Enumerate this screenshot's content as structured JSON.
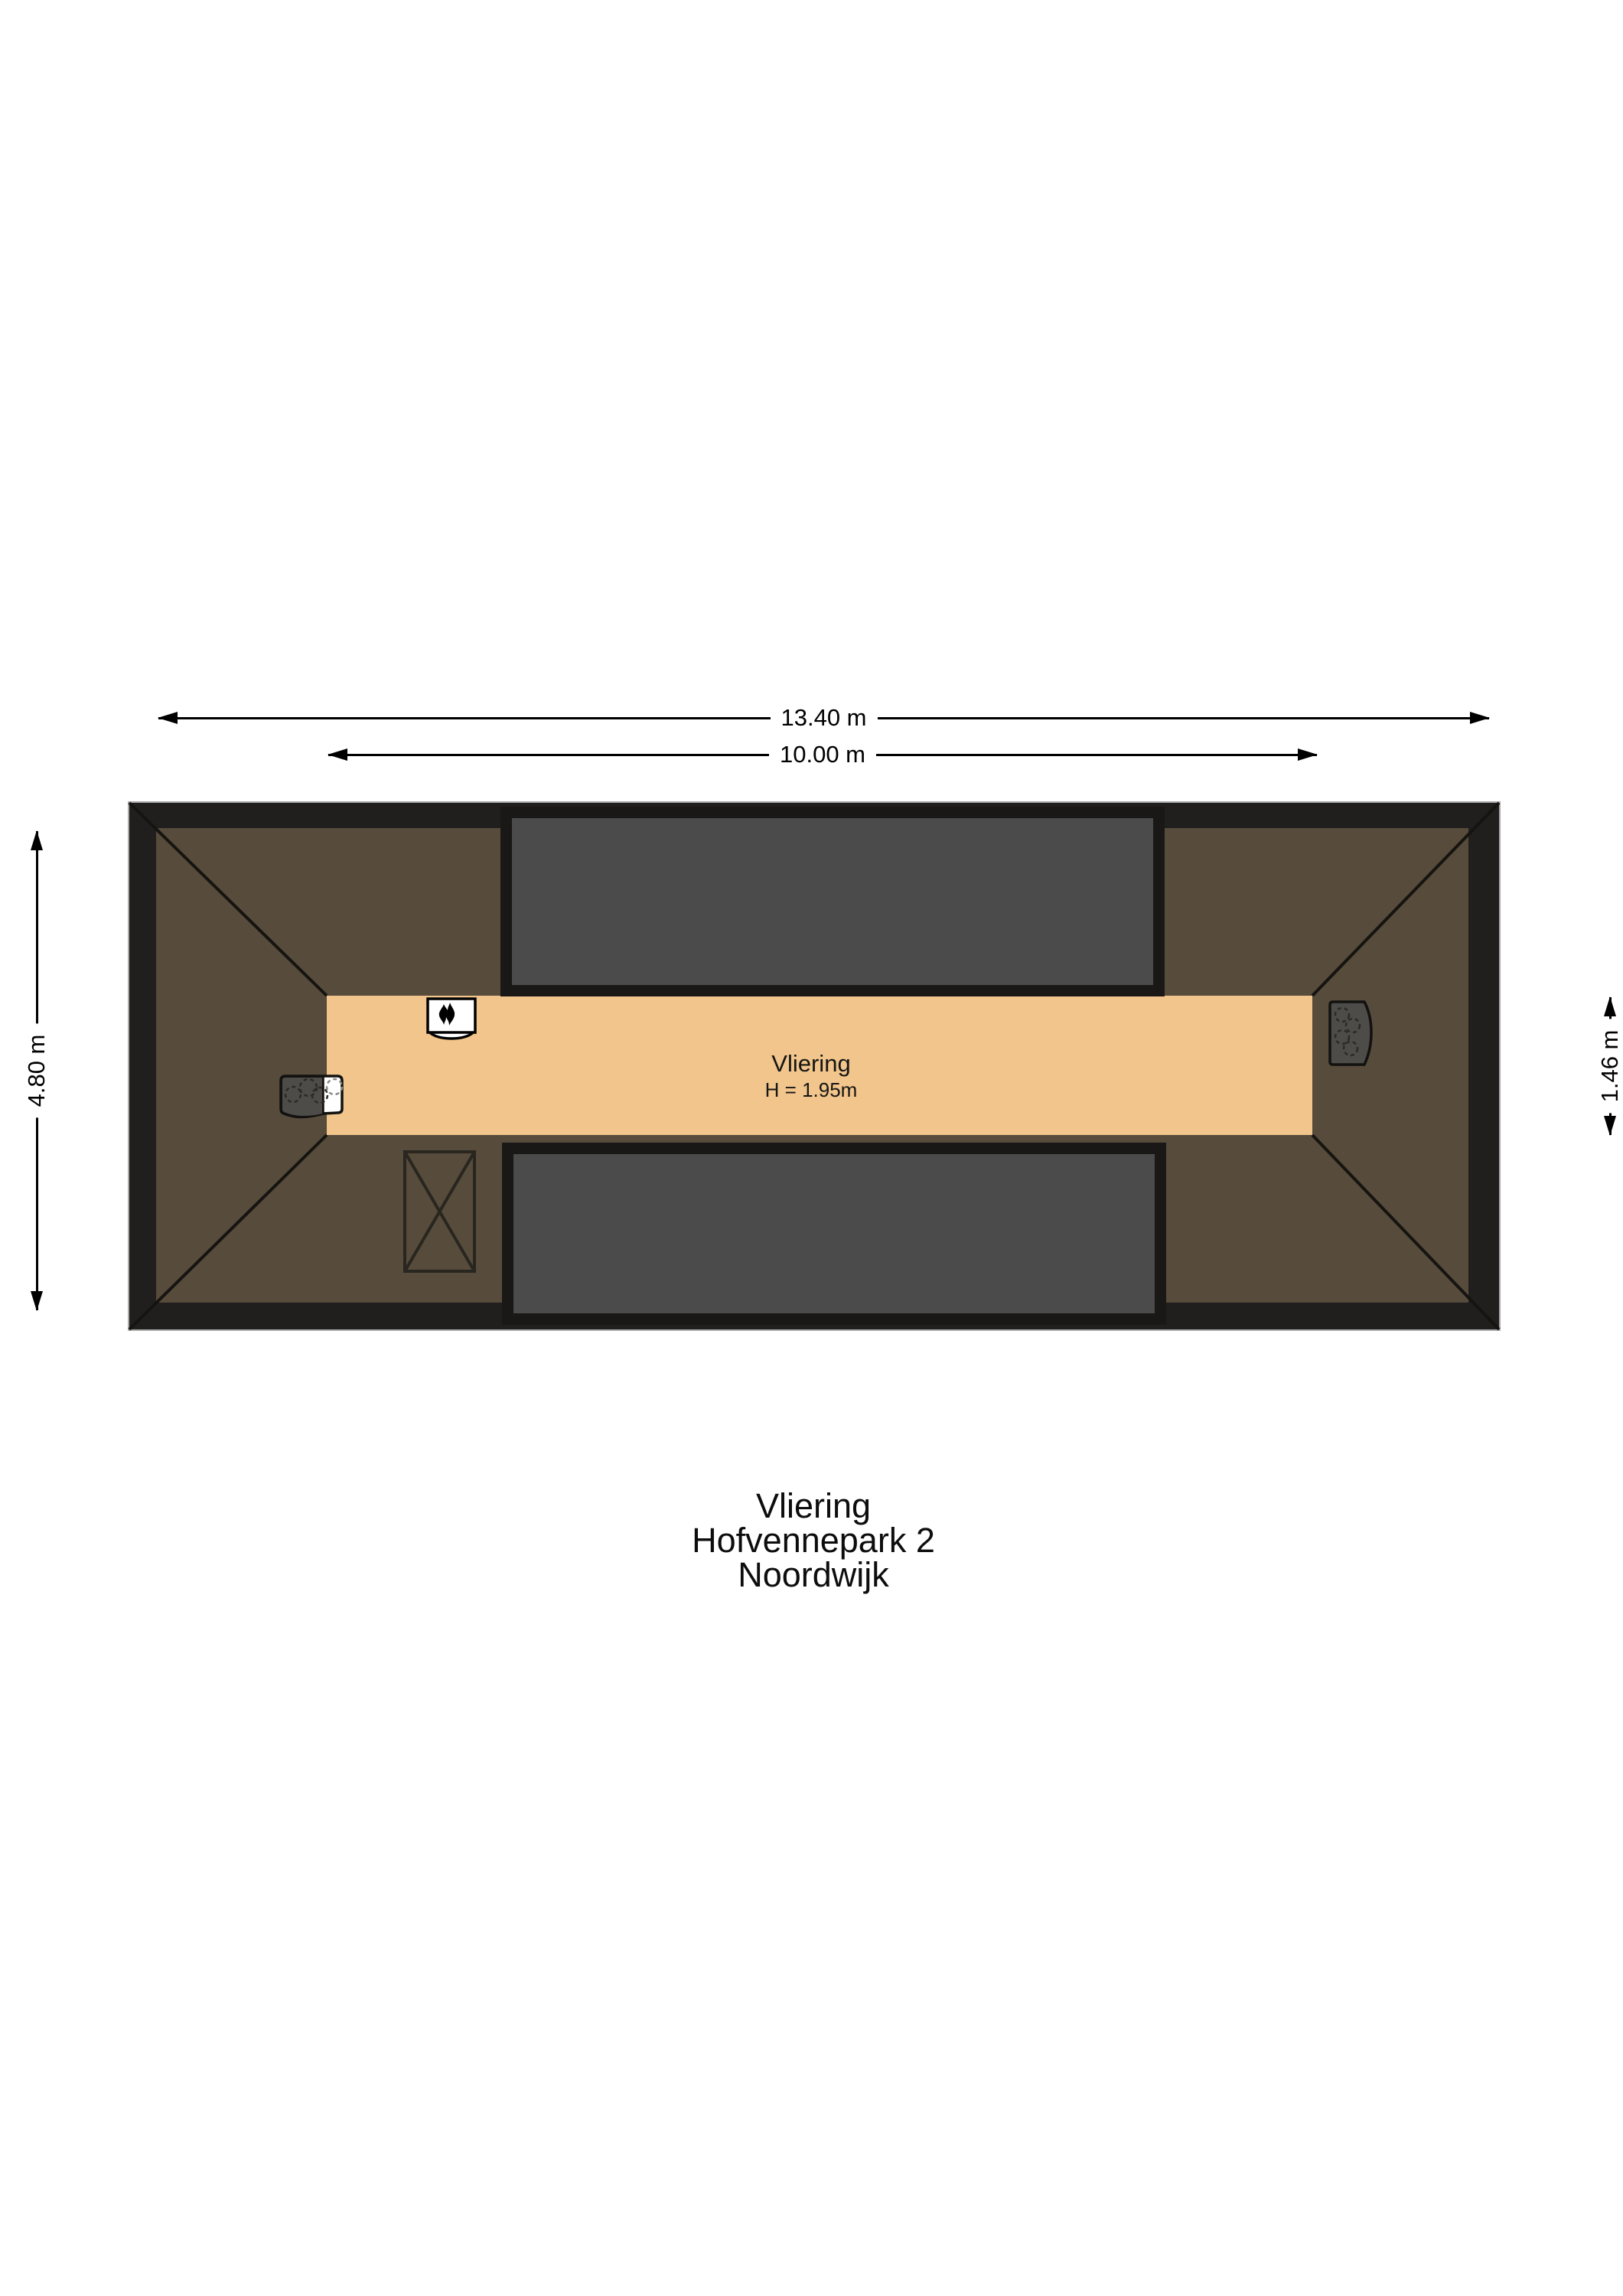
{
  "palette": {
    "background": "#ffffff",
    "wall": "#201f1d",
    "roof_area": "#574b3c",
    "floor_area": "#f1c58b",
    "panel_fill": "#4b4b4b",
    "panel_border": "#191816",
    "line": "#000000"
  },
  "dimensions": {
    "top_outer": "13.40 m",
    "top_inner": "10.00 m",
    "left_side": "4.80 m",
    "right_side": "1.46 m"
  },
  "room": {
    "name": "Vliering",
    "height_label": "H = 1.95m"
  },
  "icons": {
    "boiler": "boiler-flame-icon",
    "hob": "appliance-burners-icon",
    "vent": "ventilation-unit-icon",
    "stairs": "stair-opening-icon"
  },
  "title": {
    "room": "Vliering",
    "street": "Hofvennepark 2",
    "city": "Noordwijk"
  }
}
